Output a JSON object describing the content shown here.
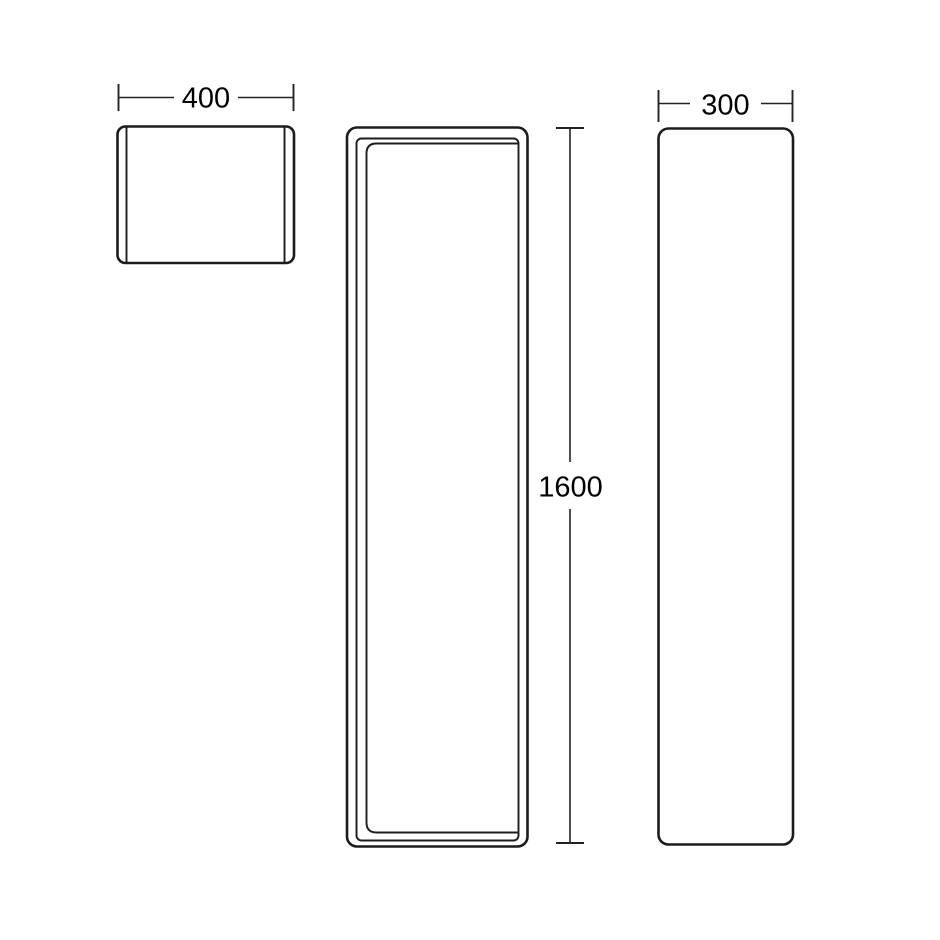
{
  "page": {
    "background": "#ffffff",
    "kind": "product technical drawing, three orthographic views of a tall cabinet"
  },
  "drawing": {
    "line_color": "#1c1c1c",
    "dimension_color": "#222222",
    "text_color": "#000000",
    "views": [
      {
        "name": "top-view-plan",
        "dimension_axis": "width",
        "dimension_label": "400"
      },
      {
        "name": "front-view",
        "dimension_axis": "height",
        "dimension_label": "1600"
      },
      {
        "name": "side-view",
        "dimension_axis": "width",
        "dimension_label": "300"
      }
    ]
  }
}
